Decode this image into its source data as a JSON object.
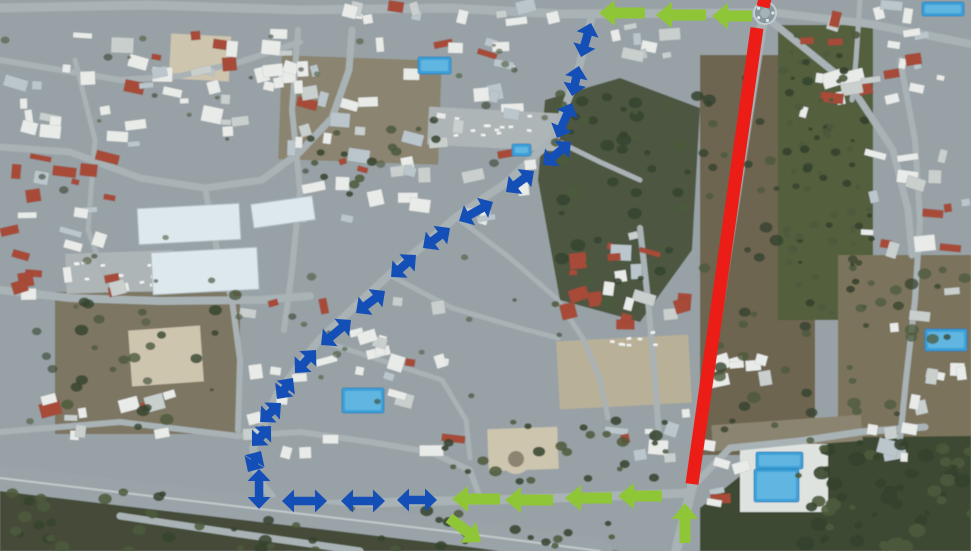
{
  "canvas": {
    "width": 971,
    "height": 551
  },
  "annotations": {
    "colors": {
      "closure_red": "#ec1d17",
      "detour_blue": "#144fb8",
      "direction_green": "#8fc637"
    },
    "closure_line": {
      "x1": 757,
      "y1": 28,
      "x2": 692,
      "y2": 484,
      "width": 13
    },
    "closure_stub": {
      "x1": 766,
      "y1": -6,
      "x2": 763,
      "y2": 7,
      "width": 13
    },
    "roundabout": {
      "cx": 765,
      "cy": 13,
      "r": 11,
      "ring": "#87999f",
      "center": "#a3b3b8",
      "rim": "#c2cdd0",
      "spoke": "#dfe6e8"
    },
    "detour_style": {
      "shaft": 8.5,
      "head_w": 23,
      "head_l": 12,
      "double_headed": true
    },
    "direction_style": {
      "shaft": 11,
      "head_w": 26,
      "head_l": 16,
      "double_headed": false
    },
    "detour_segments": [
      [
        591,
        23,
        581,
        57
      ],
      [
        579,
        66,
        572,
        96
      ],
      [
        572,
        103,
        557,
        138
      ],
      [
        571,
        142,
        543,
        165
      ],
      [
        534,
        171,
        506,
        192
      ],
      [
        493,
        202,
        459,
        221
      ],
      [
        450,
        228,
        423,
        248
      ],
      [
        416,
        255,
        391,
        277
      ],
      [
        385,
        291,
        356,
        313
      ],
      [
        351,
        320,
        321,
        345
      ],
      [
        316,
        350,
        295,
        373
      ],
      [
        293,
        378,
        277,
        399
      ],
      [
        281,
        403,
        260,
        422
      ],
      [
        271,
        426,
        252,
        446
      ],
      [
        261,
        451,
        248,
        472
      ],
      [
        259,
        469,
        259,
        509
      ],
      [
        282,
        501,
        327,
        501
      ],
      [
        341,
        501,
        385,
        501
      ],
      [
        397,
        500,
        437,
        500
      ]
    ],
    "direction_arrows": [
      [
        645,
        13,
        599,
        13
      ],
      [
        706,
        15,
        656,
        15
      ],
      [
        752,
        16,
        712,
        16
      ],
      [
        500,
        499,
        452,
        499
      ],
      [
        553,
        500,
        505,
        500
      ],
      [
        612,
        498,
        565,
        498
      ],
      [
        662,
        496,
        618,
        496
      ],
      [
        685,
        543,
        685,
        503
      ],
      [
        449,
        518,
        481,
        542
      ]
    ]
  },
  "backdrop": {
    "seed": 1337,
    "palette": {
      "base": "#98a2a6",
      "scrub_dark": "#49523a",
      "scrub_brown": "#6d6550",
      "grove": "#525f3e",
      "field": "#7b735c",
      "field2": "#7d7662",
      "below_hwy": "#454c38",
      "woods": "#3d4a30",
      "sand": "#b9b098",
      "sand_light": "#cdc5ae",
      "dirt": "#8b8470",
      "lot": "#aeb5b6",
      "deck": "#dfe3e0",
      "road": "#a9b2b5",
      "highway": "#9aa3a7",
      "lane": "#c3cacc",
      "b_white": "#e9ebe9",
      "b_gray": "#c9cfcd",
      "b_blue": "#bac6cb",
      "roof": "#a74b38",
      "tree1": "#35432e",
      "tree2": "#4c5a3c",
      "pool": "#3da0d8",
      "pool2": "#8fd0ea",
      "shed": "#dde8ed"
    },
    "terrain": [
      {
        "shape": "rect",
        "x": 0,
        "y": 0,
        "w": 971,
        "h": 551,
        "fill": "base"
      },
      {
        "shape": "poly",
        "pts": [
          [
            545,
            100
          ],
          [
            620,
            78
          ],
          [
            700,
            108
          ],
          [
            692,
            250
          ],
          [
            640,
            322
          ],
          [
            560,
            300
          ],
          [
            538,
            180
          ]
        ],
        "fill": "scrub_dark",
        "op": 0.95
      },
      {
        "shape": "rect",
        "x": 700,
        "y": 55,
        "w": 115,
        "h": 400,
        "fill": "scrub_brown"
      },
      {
        "shape": "rect",
        "x": 778,
        "y": 25,
        "w": 95,
        "h": 295,
        "fill": "grove"
      },
      {
        "shape": "rect",
        "x": 838,
        "y": 255,
        "w": 133,
        "h": 200,
        "fill": "field"
      },
      {
        "shape": "poly",
        "pts": [
          [
            0,
            486
          ],
          [
            620,
            551
          ],
          [
            0,
            551
          ]
        ],
        "fill": "below_hwy"
      },
      {
        "shape": "rect",
        "x": 558,
        "y": 338,
        "w": 132,
        "h": 68,
        "fill": "sand",
        "rot": -3
      },
      {
        "shape": "rect",
        "x": 170,
        "y": 35,
        "w": 60,
        "h": 45,
        "fill": "sand_light",
        "rot": 3
      },
      {
        "shape": "rect",
        "x": 280,
        "y": 58,
        "w": 160,
        "h": 104,
        "fill": "dirt",
        "rot": 2
      },
      {
        "shape": "rect",
        "x": 55,
        "y": 292,
        "w": 185,
        "h": 142,
        "fill": "field2"
      },
      {
        "shape": "rect",
        "x": 130,
        "y": 328,
        "w": 72,
        "h": 56,
        "fill": "sand_light",
        "rot": -4
      },
      {
        "shape": "rect",
        "x": 428,
        "y": 110,
        "w": 132,
        "h": 38,
        "fill": "lot",
        "rot": 3
      },
      {
        "shape": "rect",
        "x": 66,
        "y": 252,
        "w": 108,
        "h": 40,
        "fill": "lot",
        "rot": -2
      },
      {
        "shape": "poly",
        "pts": [
          [
            788,
            438
          ],
          [
            971,
            436
          ],
          [
            971,
            551
          ],
          [
            700,
            551
          ],
          [
            700,
            508
          ]
        ],
        "fill": "woods"
      },
      {
        "shape": "rect",
        "x": 712,
        "y": 420,
        "w": 150,
        "h": 26,
        "fill": "dirt",
        "rot": -4
      },
      {
        "shape": "rect",
        "x": 488,
        "y": 428,
        "w": 70,
        "h": 42,
        "fill": "sand_light",
        "rot": -2
      },
      {
        "shape": "circle",
        "cx": 516,
        "cy": 459,
        "r": 15,
        "fill": "sand_light"
      },
      {
        "shape": "circle",
        "cx": 516,
        "cy": 459,
        "r": 8,
        "fill": "dirt"
      },
      {
        "shape": "rect",
        "x": 740,
        "y": 444,
        "w": 88,
        "h": 68,
        "fill": "deck"
      }
    ],
    "roads": [
      {
        "pts": [
          [
            0,
            8
          ],
          [
            150,
            5
          ],
          [
            300,
            10
          ],
          [
            450,
            8
          ],
          [
            560,
            14
          ],
          [
            752,
            13
          ]
        ],
        "w": 9
      },
      {
        "pts": [
          [
            778,
            13
          ],
          [
            870,
            24
          ],
          [
            971,
            44
          ]
        ],
        "w": 8
      },
      {
        "pts": [
          [
            772,
            22
          ],
          [
            850,
            85
          ],
          [
            893,
            150
          ],
          [
            908,
            210
          ],
          [
            912,
            255
          ]
        ],
        "w": 7
      },
      {
        "pts": [
          [
            762,
            25
          ],
          [
            738,
            180
          ],
          [
            713,
            340
          ],
          [
            692,
            487
          ],
          [
            676,
            551
          ]
        ],
        "w": 10
      },
      {
        "pts": [
          [
            228,
            508
          ],
          [
            400,
            502
          ],
          [
            560,
            498
          ],
          [
            688,
            493
          ]
        ],
        "w": 9
      },
      {
        "pts": [
          [
            592,
            16
          ],
          [
            577,
            75
          ],
          [
            553,
            139
          ],
          [
            506,
            183
          ],
          [
            456,
            217
          ],
          [
            389,
            275
          ],
          [
            319,
            340
          ],
          [
            277,
            394
          ],
          [
            253,
            448
          ],
          [
            257,
            478
          ],
          [
            272,
            497
          ]
        ],
        "w": 8
      },
      {
        "pts": [
          [
            0,
            478
          ],
          [
            150,
            496
          ],
          [
            320,
            516
          ],
          [
            470,
            534
          ],
          [
            600,
            551
          ]
        ],
        "w": 26,
        "c": "highway"
      },
      {
        "pts": [
          [
            0,
            478
          ],
          [
            150,
            496
          ],
          [
            320,
            516
          ],
          [
            470,
            534
          ],
          [
            600,
            551
          ]
        ],
        "w": 2,
        "c": "lane"
      },
      {
        "pts": [
          [
            120,
            516
          ],
          [
            240,
            534
          ],
          [
            360,
            551
          ]
        ],
        "w": 7
      },
      {
        "pts": [
          [
            0,
            147
          ],
          [
            70,
            152
          ],
          [
            140,
            178
          ],
          [
            205,
            188
          ],
          [
            262,
            180
          ],
          [
            300,
            152
          ],
          [
            332,
            118
          ],
          [
            349,
            70
          ],
          [
            352,
            30
          ]
        ],
        "w": 7
      },
      {
        "pts": [
          [
            205,
            188
          ],
          [
            218,
            255
          ],
          [
            232,
            300
          ],
          [
            240,
            360
          ],
          [
            238,
            430
          ]
        ],
        "w": 6
      },
      {
        "pts": [
          [
            0,
            290
          ],
          [
            70,
            298
          ],
          [
            160,
            301
          ],
          [
            260,
            300
          ],
          [
            310,
            296
          ]
        ],
        "w": 8
      },
      {
        "pts": [
          [
            0,
            432
          ],
          [
            120,
            422
          ],
          [
            238,
            436
          ],
          [
            300,
            432
          ],
          [
            370,
            442
          ],
          [
            430,
            452
          ],
          [
            470,
            470
          ],
          [
            478,
            492
          ]
        ],
        "w": 6
      },
      {
        "pts": [
          [
            298,
            30
          ],
          [
            292,
            110
          ],
          [
            300,
            190
          ],
          [
            292,
            270
          ],
          [
            284,
            330
          ]
        ],
        "w": 6
      },
      {
        "pts": [
          [
            389,
            275
          ],
          [
            452,
            308
          ],
          [
            520,
            328
          ],
          [
            558,
            338
          ]
        ],
        "w": 5
      },
      {
        "pts": [
          [
            319,
            340
          ],
          [
            380,
            360
          ],
          [
            442,
            380
          ],
          [
            466,
            420
          ],
          [
            470,
            458
          ]
        ],
        "w": 5
      },
      {
        "pts": [
          [
            456,
            217
          ],
          [
            510,
            258
          ],
          [
            556,
            298
          ],
          [
            584,
            340
          ],
          [
            600,
            380
          ],
          [
            608,
            418
          ]
        ],
        "w": 5
      },
      {
        "pts": [
          [
            640,
            228
          ],
          [
            648,
            300
          ],
          [
            655,
            380
          ],
          [
            660,
            452
          ]
        ],
        "w": 6
      },
      {
        "pts": [
          [
            900,
            60
          ],
          [
            915,
            140
          ],
          [
            920,
            220
          ],
          [
            915,
            300
          ],
          [
            906,
            380
          ],
          [
            900,
            440
          ]
        ],
        "w": 6
      },
      {
        "pts": [
          [
            860,
            0
          ],
          [
            856,
            60
          ],
          [
            852,
            100
          ]
        ],
        "w": 5
      },
      {
        "pts": [
          [
            692,
            487
          ],
          [
            730,
            448
          ],
          [
            800,
            441
          ],
          [
            860,
            432
          ],
          [
            925,
            427
          ]
        ],
        "w": 7
      },
      {
        "pts": [
          [
            0,
            60
          ],
          [
            60,
            70
          ],
          [
            120,
            80
          ],
          [
            180,
            76
          ],
          [
            240,
            62
          ],
          [
            300,
            42
          ]
        ],
        "w": 6
      },
      {
        "pts": [
          [
            75,
            60
          ],
          [
            95,
            140
          ],
          [
            88,
            230
          ],
          [
            108,
            285
          ]
        ],
        "w": 5
      },
      {
        "pts": [
          [
            553,
            139
          ],
          [
            600,
            162
          ],
          [
            640,
            180
          ]
        ],
        "w": 5
      }
    ],
    "sheds": [
      [
        138,
        206,
        102,
        36,
        -3
      ],
      [
        152,
        250,
        106,
        42,
        -3
      ],
      [
        252,
        200,
        62,
        24,
        -8
      ]
    ],
    "specks": [
      [
        432,
        114,
        124,
        30,
        16
      ],
      [
        70,
        258,
        98,
        30,
        12
      ],
      [
        600,
        330,
        60,
        24,
        8
      ]
    ],
    "pools": [
      [
        418,
        57,
        33,
        17
      ],
      [
        512,
        144,
        19,
        12
      ],
      [
        342,
        388,
        42,
        25
      ],
      [
        756,
        452,
        47,
        17
      ],
      [
        754,
        469,
        45,
        33
      ],
      [
        922,
        2,
        42,
        14
      ],
      [
        925,
        329,
        42,
        22
      ]
    ],
    "building_zones": [
      [
        0,
        28,
        330,
        120,
        48,
        0.12
      ],
      [
        0,
        150,
        135,
        155,
        26,
        0.5
      ],
      [
        255,
        35,
        290,
        195,
        50,
        0.08
      ],
      [
        235,
        295,
        235,
        165,
        32,
        0.05
      ],
      [
        560,
        225,
        132,
        112,
        20,
        0.4
      ],
      [
        598,
        405,
        95,
        60,
        9,
        0.1
      ],
      [
        705,
        352,
        75,
        48,
        7,
        0
      ],
      [
        800,
        0,
        168,
        128,
        26,
        0.12
      ],
      [
        855,
        135,
        116,
        168,
        16,
        0.2
      ],
      [
        888,
        300,
        80,
        145,
        8,
        0.1
      ],
      [
        5,
        390,
        230,
        55,
        11,
        0.15
      ],
      [
        340,
        0,
        220,
        26,
        12,
        0.05
      ],
      [
        598,
        22,
        85,
        42,
        8,
        0.1
      ],
      [
        700,
        438,
        58,
        80,
        6,
        0.05
      ],
      [
        858,
        418,
        110,
        44,
        6,
        0.05
      ]
    ],
    "veg_zones": [
      [
        782,
        30,
        90,
        285,
        70,
        2,
        5,
        0.9
      ],
      [
        548,
        92,
        150,
        215,
        48,
        3,
        8,
        0.85
      ],
      [
        702,
        70,
        110,
        385,
        40,
        3,
        7,
        0.8
      ],
      [
        0,
        492,
        210,
        59,
        22,
        3,
        8,
        0.85
      ],
      [
        210,
        505,
        250,
        46,
        18,
        3,
        7,
        0.85
      ],
      [
        455,
        522,
        160,
        29,
        10,
        3,
        6,
        0.85
      ],
      [
        440,
        420,
        245,
        62,
        26,
        3,
        7,
        0.85
      ],
      [
        60,
        292,
        180,
        140,
        22,
        3,
        7,
        0.8
      ],
      [
        838,
        258,
        130,
        195,
        24,
        3,
        7,
        0.75
      ],
      [
        795,
        440,
        176,
        108,
        55,
        3,
        9,
        0.9
      ],
      [
        305,
        112,
        135,
        82,
        16,
        3,
        6,
        0.85
      ],
      [
        0,
        30,
        560,
        400,
        55,
        2,
        5,
        0.6
      ]
    ]
  }
}
